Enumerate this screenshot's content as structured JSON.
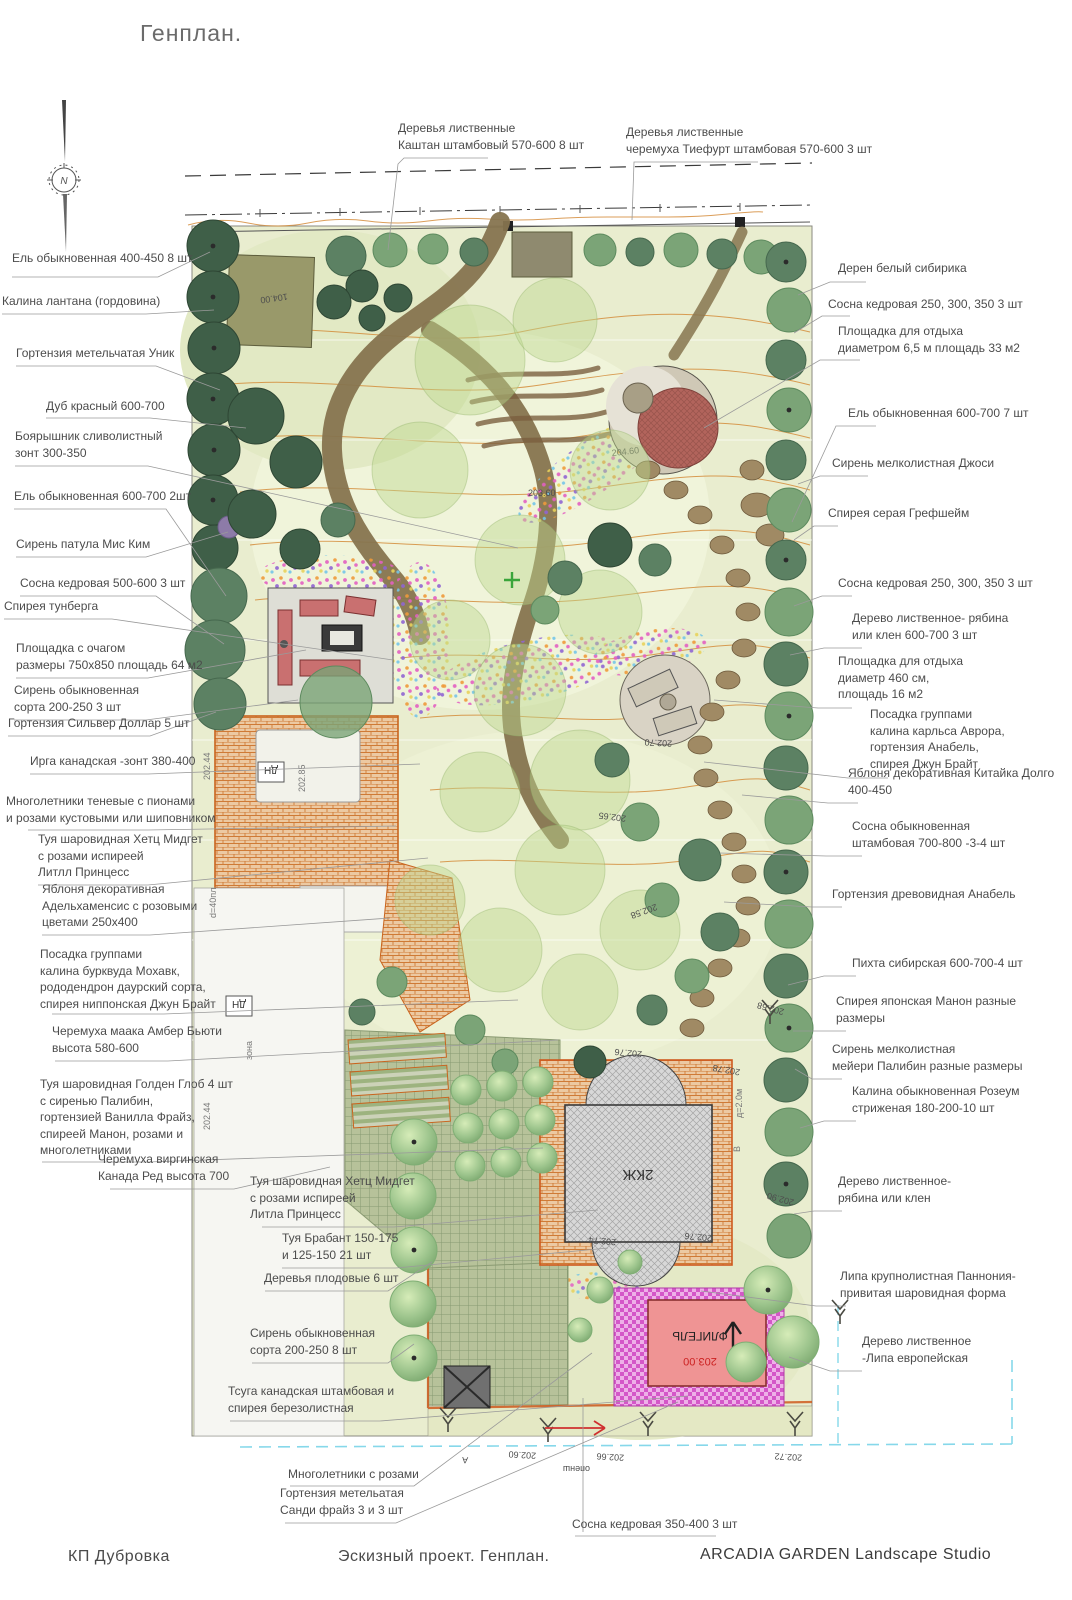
{
  "header": {
    "title": "Генплан."
  },
  "footer": {
    "left": "КП Дубровка",
    "center": "Эскизный проект. Генплан.",
    "right": "ARCADIA GARDEN  Landscape Studio"
  },
  "callouts": {
    "top": [
      {
        "text": "Деревья лиственные\nКаштан штамбовый 570-600 8 шт"
      },
      {
        "text": "Деревья лиственные\nчеремуха Тиефурт штамбовая  570-600  3 шт"
      }
    ],
    "left": [
      {
        "text": "Ель обыкновенная 400-450 8 шт"
      },
      {
        "text": "Калина лантана (гордовина)"
      },
      {
        "text": "Гортензия метельчатая Уник"
      },
      {
        "text": "Дуб красный  600-700"
      },
      {
        "text": "Боярышник сливолистный\nзонт 300-350"
      },
      {
        "text": "Ель обыкновенная 600-700 2шт"
      },
      {
        "text": "Сирень патула Мис Ким"
      },
      {
        "text": "Сосна кедровая 500-600 3 шт"
      },
      {
        "text": "Спирея тунберга"
      },
      {
        "text": "Площадка с очагом\nразмеры 750х850 площадь 64 м2"
      },
      {
        "text": "Сирень обыкновенная\nсорта 200-250 3 шт"
      },
      {
        "text": "Гортензия Сильвер Доллар 5 шт"
      },
      {
        "text": "Ирга канадская -зонт 380-400"
      },
      {
        "text": "Многолетники теневые с пионами\nи розами кустовыми или шиповником"
      },
      {
        "text": "Туя шаровидная Хетц Мидгет\nс розами испиреей\nЛитлл Принцесс"
      },
      {
        "text": "Яблоня декоративная\nАдельхаменсис с розовыми\nцветами 250х400"
      },
      {
        "text": "Посадка группами\nкалина бурквуда Мохавк,\nрододендрон даурский сорта,\nспирея ниппонская Джун Брайт"
      },
      {
        "text": "Черемуха маака Амбер Бьюти\nвысота 580-600"
      },
      {
        "text": "Туя шаровидная Голден Глоб 4 шт\nс сиренью Палибин,\nгортензией Ванилла Фрайз,\nспиреей Манон, розами и\nмноголетниками"
      },
      {
        "text": "Черемуха виргинская\nКанада Ред высота 700"
      },
      {
        "text": "Туя шаровидная Хетц Мидгет\nс розами испиреей\nЛитла Принцесс"
      },
      {
        "text": "Туя Брабант 150-175\nи 125-150 21 шт"
      },
      {
        "text": "Деревья плодовые 6 шт"
      },
      {
        "text": "Сирень обыкновенная\nсорта 200-250 8 шт"
      },
      {
        "text": "Тсуга канадская штамбовая и\nспирея березолистная"
      },
      {
        "text": "Многолетники с розами"
      },
      {
        "text": "Гортензия метельатая\nСанди фрайз 3 и 3 шт"
      },
      {
        "text": "Сосна кедровая 350-400 3 шт"
      }
    ],
    "right": [
      {
        "text": "Дерен белый сибирика"
      },
      {
        "text": "Сосна кедровая 250, 300, 350 3 шт"
      },
      {
        "text": "Площадка для отдыха\nдиаметром 6,5 м площадь 33 м2"
      },
      {
        "text": "Ель обыкновенная 600-700 7 шт"
      },
      {
        "text": "Сирень мелколистная Джоси"
      },
      {
        "text": "Спирея серая Грефшейм"
      },
      {
        "text": "Сосна кедровая 250, 300, 350 3 шт"
      },
      {
        "text": "Дерево лиственное- рябина\nили клен 600-700 3 шт"
      },
      {
        "text": "Площадка для отдыха\nдиаметр 460 см,\nплощадь 16 м2"
      },
      {
        "text": "Посадка группами\nкалина карльса Аврора,\nгортензия Анабель,\nспирея Джун Брайт"
      },
      {
        "text": "Яблоня декоративная Китайка Долго\n400-450"
      },
      {
        "text": "Сосна обыкновенная\nштамбовая  700-800 -3-4  шт"
      },
      {
        "text": "Гортензия древовидная Анабель"
      },
      {
        "text": "Пихта сибирская 600-700-4 шт"
      },
      {
        "text": "Спирея японская Манон разные\nразмеры"
      },
      {
        "text": "Сирень мелколистная\nмейери Палибин разные размеры"
      },
      {
        "text": "Калина обыкновенная Розеум\nстриженая 180-200-10 шт"
      },
      {
        "text": "Дерево лиственное-\nрябина или клен"
      },
      {
        "text": "Липа крупнолистная Паннония-\nпривитая шаровидная форма"
      },
      {
        "text": "Дерево лиственное\n-Липа европейская"
      }
    ]
  },
  "plan_texts": {
    "north": "N",
    "building_main": "2КЖ",
    "building_annex": "ФЛИГЕЛЬ",
    "annex_elevation": "203.00",
    "dn1": "ДН",
    "dn2": "ДН",
    "zone": "зона",
    "mark_104": "104.00",
    "mark_203_60": "203.60",
    "mark_204_60": "204.60",
    "mark_202_70": "202.70",
    "mark_202_65": "202.65",
    "mark_202_58": "202.58",
    "mark_202_85": "202.85",
    "mark_202_44a": "202.44",
    "mark_202_44b": "202.44",
    "mark_202_68": "202.68",
    "mark_202_76": "202.76",
    "mark_202_74": "202.74",
    "mark_202_76b": "202.76",
    "mark_202_78": "202.78",
    "mark_202_90": "202.90",
    "mark_202_60": "202.60",
    "mark_202_66": "202.66",
    "mark_202_72": "202.72",
    "mark_d40": "d=40пл",
    "mark_d20": "д=2.0м",
    "mark_A": "А",
    "mark_B": "В",
    "mark_shnepo": "опенш"
  },
  "colors": {
    "lawn": "#e9edcf",
    "contour_orange": "#d28631",
    "path_brown": "#86744f",
    "brick_orange": "#cf7a35",
    "paving_magenta": "#d457c8",
    "building_grey": "#d8d8d8",
    "annex_pink": "#ef9494",
    "water_blue": "#86d8ea",
    "conifer_dark": "#3f5f48"
  }
}
